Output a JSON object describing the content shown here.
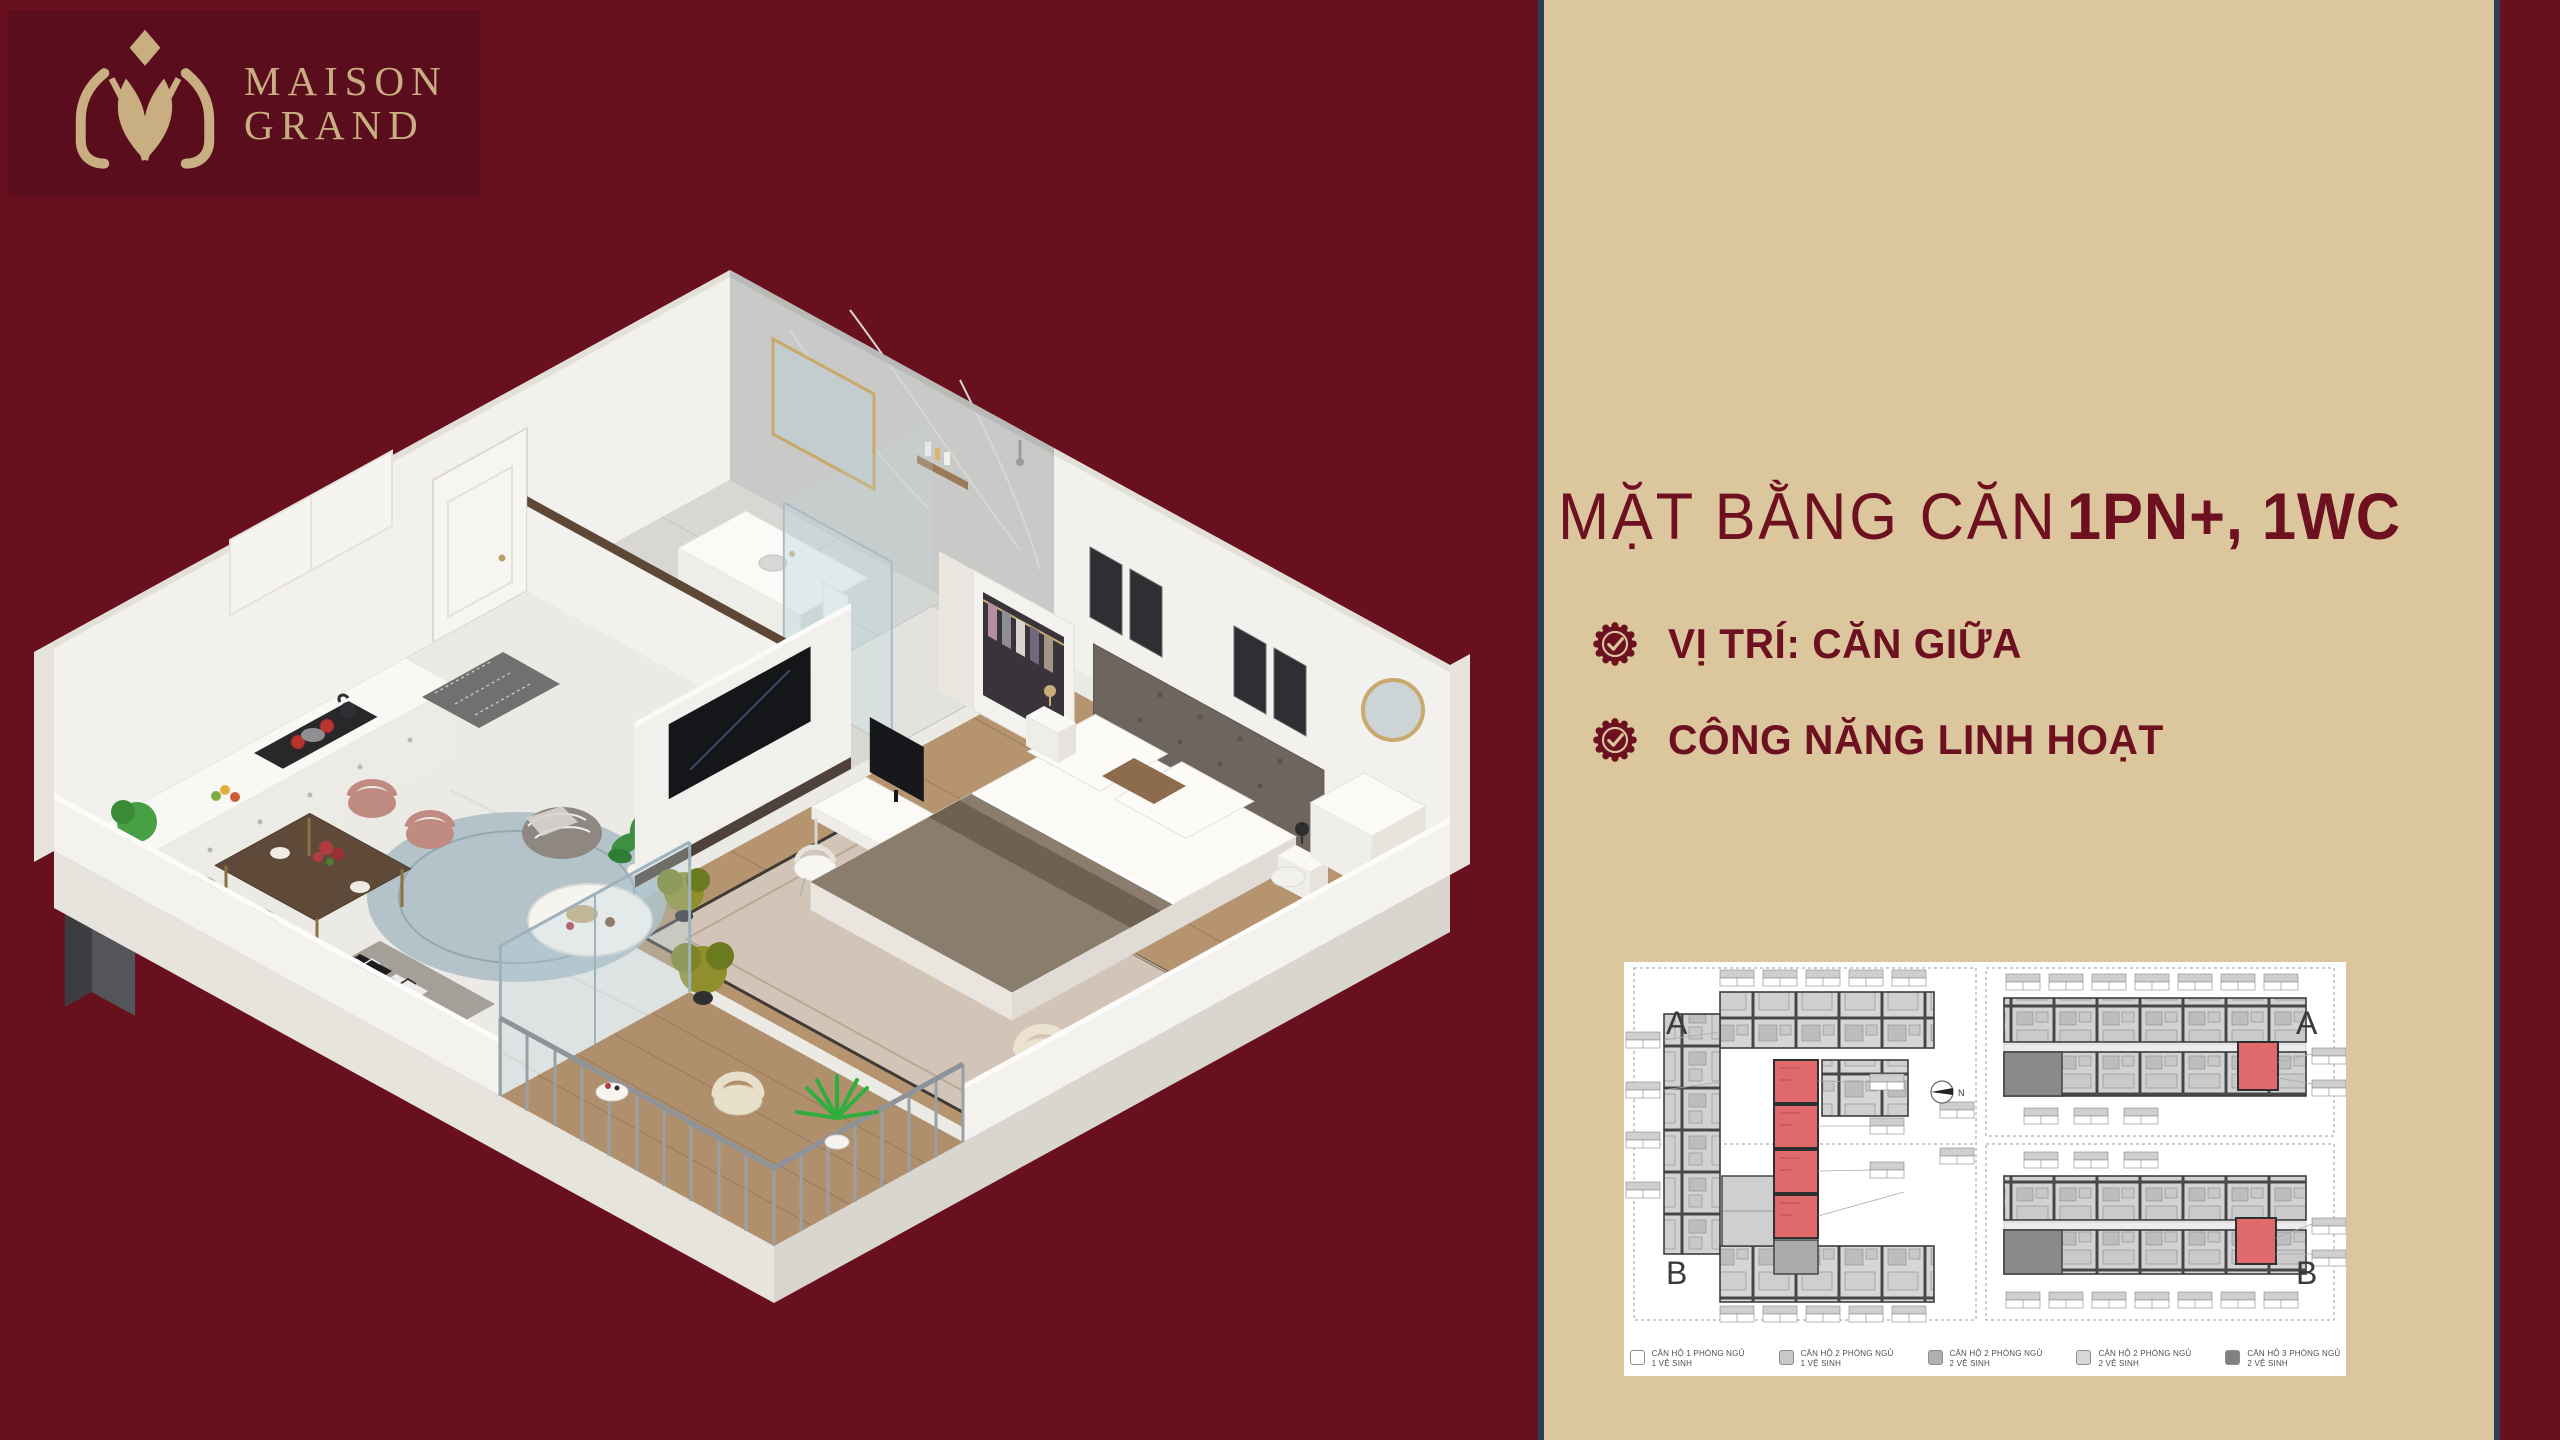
{
  "logo": {
    "brand_line1": "MAISON",
    "brand_line2": "GRAND"
  },
  "panel": {
    "title_regular": "MẶT BẰNG CĂN",
    "title_bold": "1PN+, 1WC",
    "features": [
      {
        "label": "VỊ TRÍ: CĂN GIỮA"
      },
      {
        "label": "CÔNG NĂNG LINH HOẠT"
      }
    ]
  },
  "floorplan": {
    "tower_left": {
      "label_top": "A",
      "label_bottom": "B"
    },
    "tower_right": {
      "label_top": "A",
      "label_bottom": "B"
    },
    "compass_label": "N",
    "legend": [
      {
        "line1": "CĂN HỘ 1 PHÒNG NGỦ",
        "line2": "1 VỆ SINH",
        "swatch": "#ffffff"
      },
      {
        "line1": "CĂN HỘ 2 PHÒNG NGỦ",
        "line2": "1 VỆ SINH",
        "swatch": "#c9c9c9"
      },
      {
        "line1": "CĂN HỘ 2 PHÒNG NGỦ",
        "line2": "2 VỆ SINH",
        "swatch": "#b0b0b0"
      },
      {
        "line1": "CĂN HỘ 2 PHÒNG NGỦ",
        "line2": "2 VỆ SINH",
        "swatch": "#d8d8d8"
      },
      {
        "line1": "CĂN HỘ 3 PHÒNG NGỦ",
        "line2": "2 VỆ SINH",
        "swatch": "#808080"
      }
    ]
  },
  "colors": {
    "maroon_bg": "#69101f",
    "logo_box": "#5a0e1d",
    "gold": "#c9ae82",
    "panel_beige": "#dcc69d",
    "panel_border_navy": "#2d3f58",
    "title_maroon": "#6d1120",
    "highlight_red": "#e0696c"
  }
}
